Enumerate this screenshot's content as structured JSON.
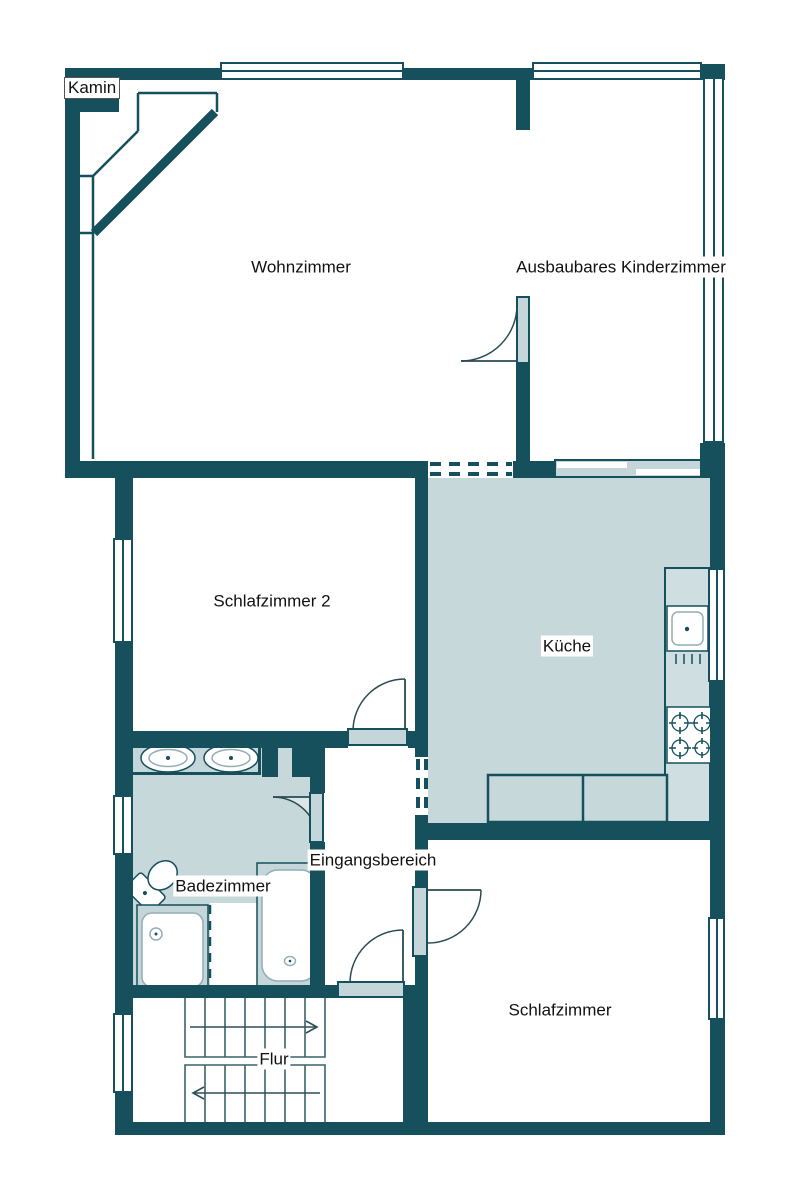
{
  "plan": {
    "title": "Grundriss",
    "rooms": {
      "kamin": "Kamin",
      "wohnzimmer": "Wohnzimmer",
      "kinderzimmer": "Ausbaubares Kinderzimmer",
      "schlafzimmer2": "Schlafzimmer 2",
      "kueche": "Küche",
      "eingangsbereich": "Eingangsbereich",
      "badezimmer": "Badezimmer",
      "schlafzimmer": "Schlafzimmer",
      "flur": "Flur"
    },
    "colors": {
      "wall": "#15505c",
      "room_fill": "#c7d8da",
      "fixture_fill": "#c4d6d9",
      "counter_fill": "#cfdfe1",
      "door_arc_fill": "#dce6e8",
      "stair_line": "#3d626b",
      "text": "#111111"
    }
  }
}
